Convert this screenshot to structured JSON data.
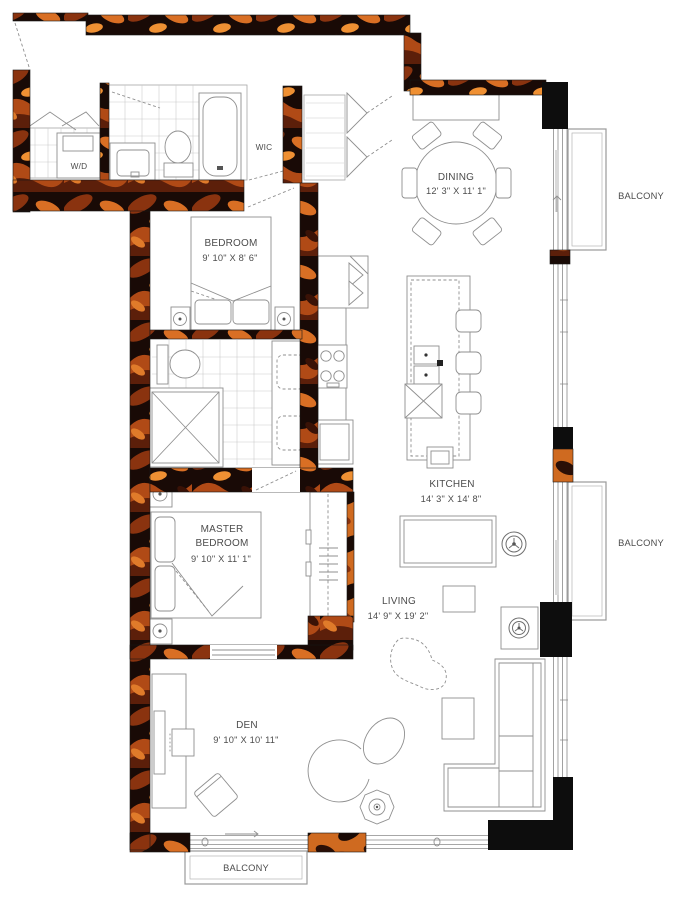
{
  "plan_title": "2 Bedroom + Den Suite Floor Plan",
  "rooms": {
    "laundry": {
      "name": "W/D"
    },
    "wic": {
      "name": "WIC"
    },
    "bedroom": {
      "name": "BEDROOM",
      "dims": "9' 10\" X 8' 6\""
    },
    "dining": {
      "name": "DINING",
      "dims": "12' 3\" X 11' 1\""
    },
    "kitchen": {
      "name": "KITCHEN",
      "dims": "14' 3\" X 14' 8\""
    },
    "master": {
      "name_line1": "MASTER",
      "name_line2": "BEDROOM",
      "dims": "9' 10\" X 11' 1\""
    },
    "living": {
      "name": "LIVING",
      "dims": "14' 9\" X 19' 2\""
    },
    "den": {
      "name": "DEN",
      "dims": "9' 10\" X 10' 11\""
    }
  },
  "balconies": {
    "right_upper": "BALCONY",
    "right_lower": "BALCONY",
    "bottom": "BALCONY"
  },
  "colors": {
    "wall_black": "#0d0d0d",
    "wall_orange": "#cf6a20",
    "wall_orange_bright": "#ef9033",
    "wall_brown": "#5c1f0a",
    "furniture_line": "#8f8f8f",
    "label_text": "#4c4c4c"
  }
}
